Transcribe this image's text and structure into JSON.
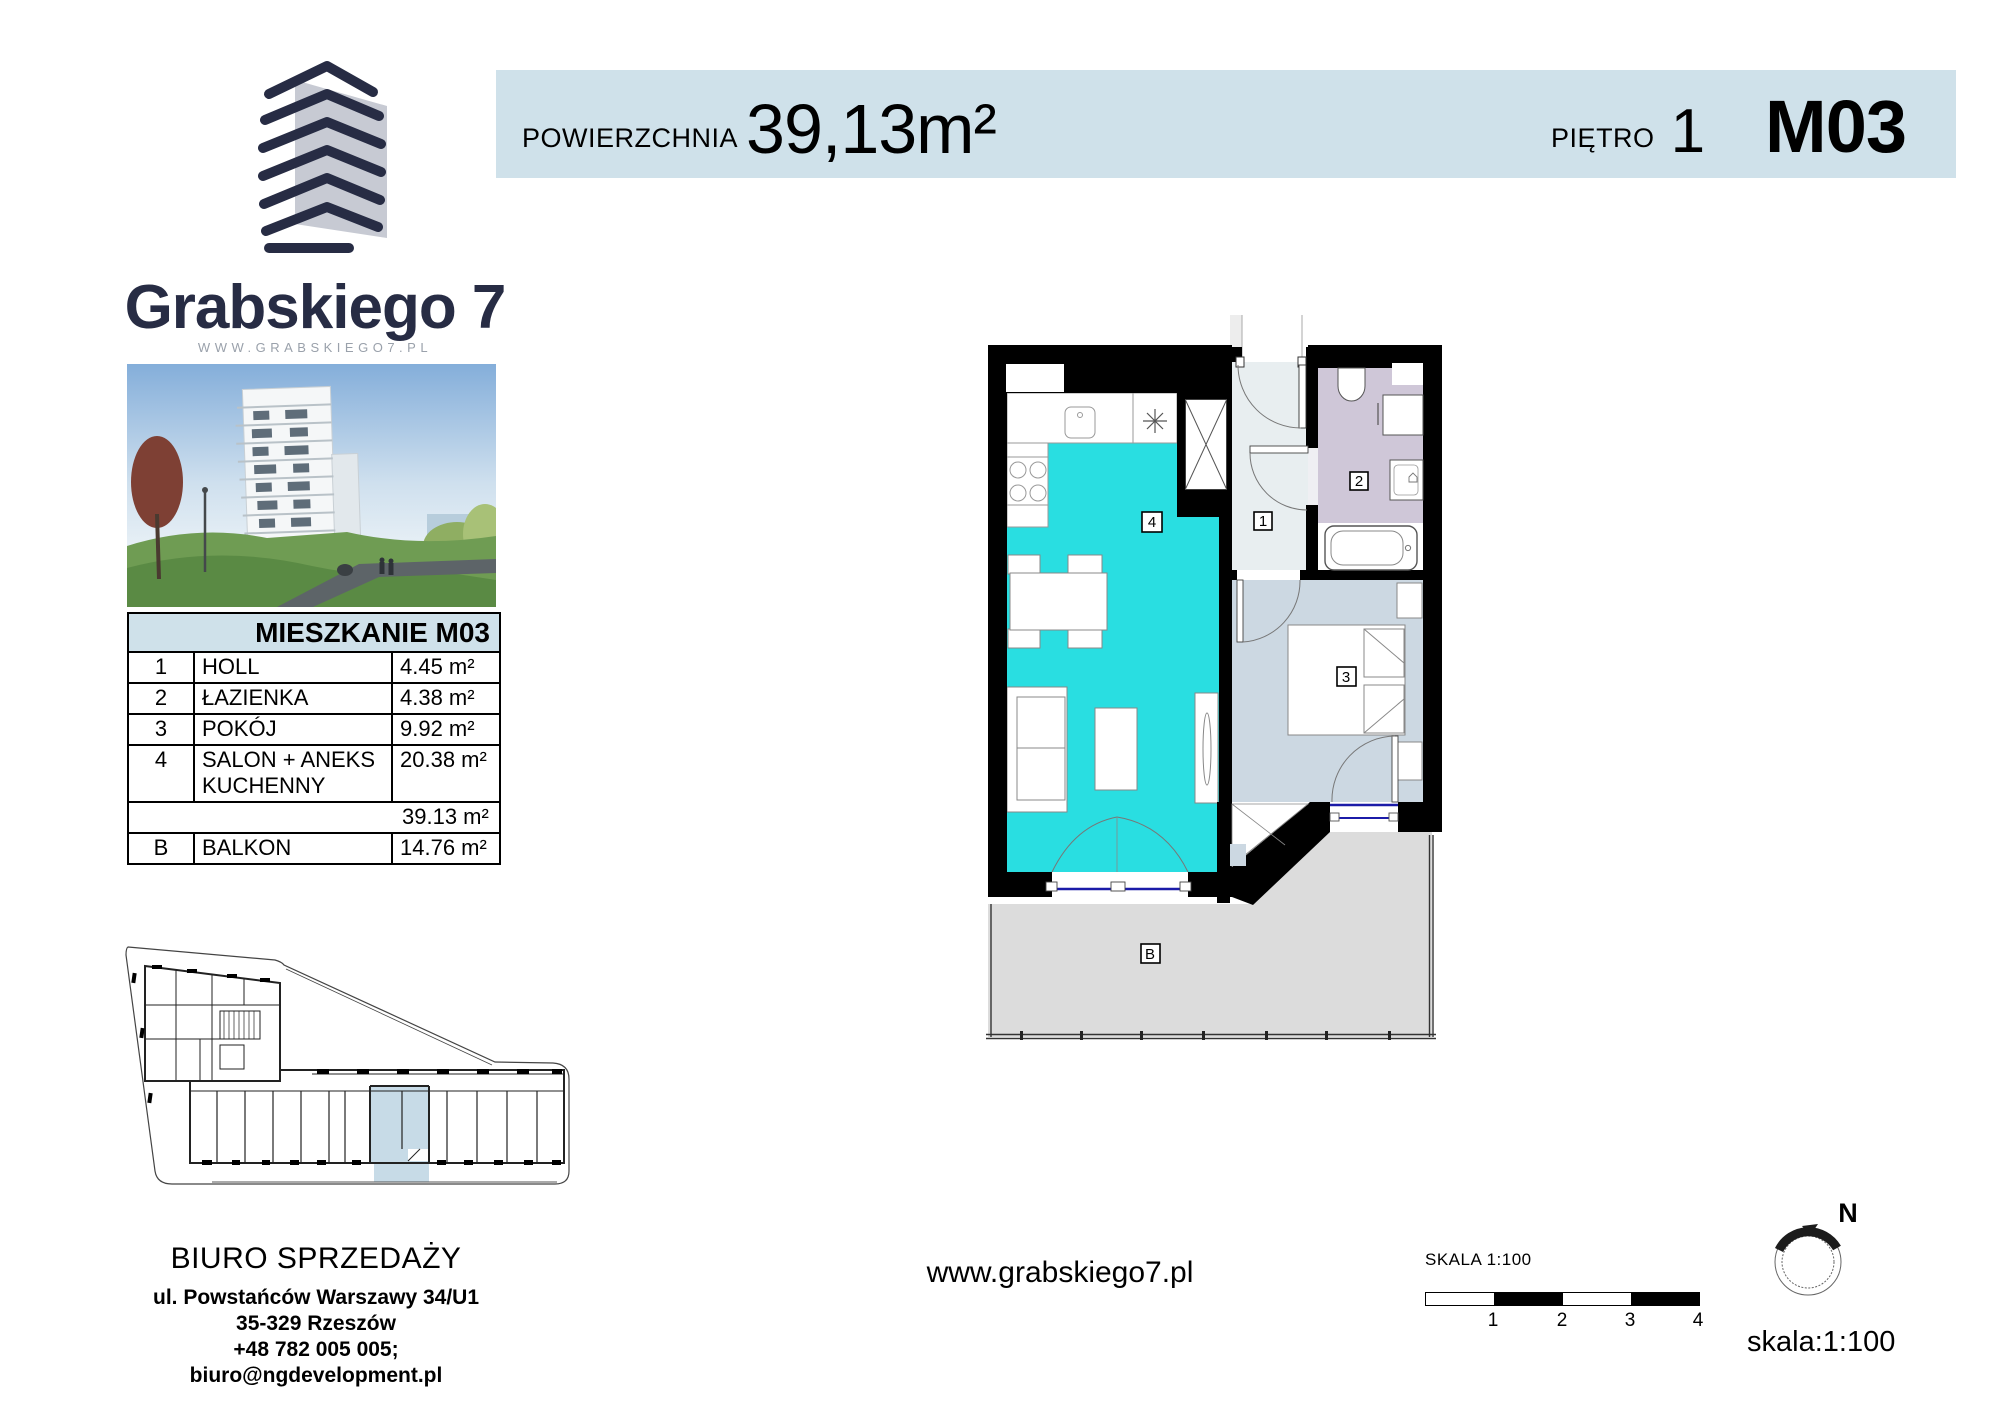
{
  "header": {
    "area_label": "POWIERZCHNIA",
    "area_value": "39,13m²",
    "floor_label": "PIĘTRO",
    "floor_value": "1",
    "unit_code": "M03"
  },
  "brand": {
    "name": "Grabskiego 7",
    "website": "WWW.GRABSKIEGO7.PL"
  },
  "unit_table": {
    "title": "MIESZKANIE M03",
    "rows": [
      {
        "no": "1",
        "name": "HOLL",
        "area": "4.45 m²"
      },
      {
        "no": "2",
        "name": "ŁAZIENKA",
        "area": "4.38 m²"
      },
      {
        "no": "3",
        "name": "POKÓJ",
        "area": "9.92 m²"
      },
      {
        "no": "4",
        "name": "SALON + ANEKS KUCHENNY",
        "area": "20.38 m²"
      }
    ],
    "total_area": "39.13 m²",
    "balcony": {
      "no": "B",
      "name": "BALKON",
      "area": "14.76 m²"
    }
  },
  "plan": {
    "labels": {
      "hall": "1",
      "bathroom": "2",
      "room": "3",
      "living": "4",
      "balcony": "B"
    }
  },
  "contact": {
    "title": "BIURO SPRZEDAŻY",
    "lines": [
      "ul. Powstańców Warszawy 34/U1",
      "35-329 Rzeszów",
      "+48 782 005 005;",
      "biuro@ngdevelopment.pl"
    ]
  },
  "footer": {
    "website": "www.grabskiego7.pl",
    "scale_label": "SKALA 1:100",
    "scale_ticks": [
      "1",
      "2",
      "3",
      "4"
    ],
    "north": "N",
    "scale_note": "skala:1:100"
  },
  "colors": {
    "header_bg": "#cfe1ea",
    "navy": "#272c44",
    "muted": "#9aa1ab",
    "cyan": "#29dee1",
    "hall": "#e8eef0",
    "bath": "#cfc7d8",
    "bedroom": "#ccd8e2",
    "balcony": "#dcdcdc",
    "window_blue": "#1b1ba8",
    "keyplan_highlight": "#c7dbe7"
  }
}
